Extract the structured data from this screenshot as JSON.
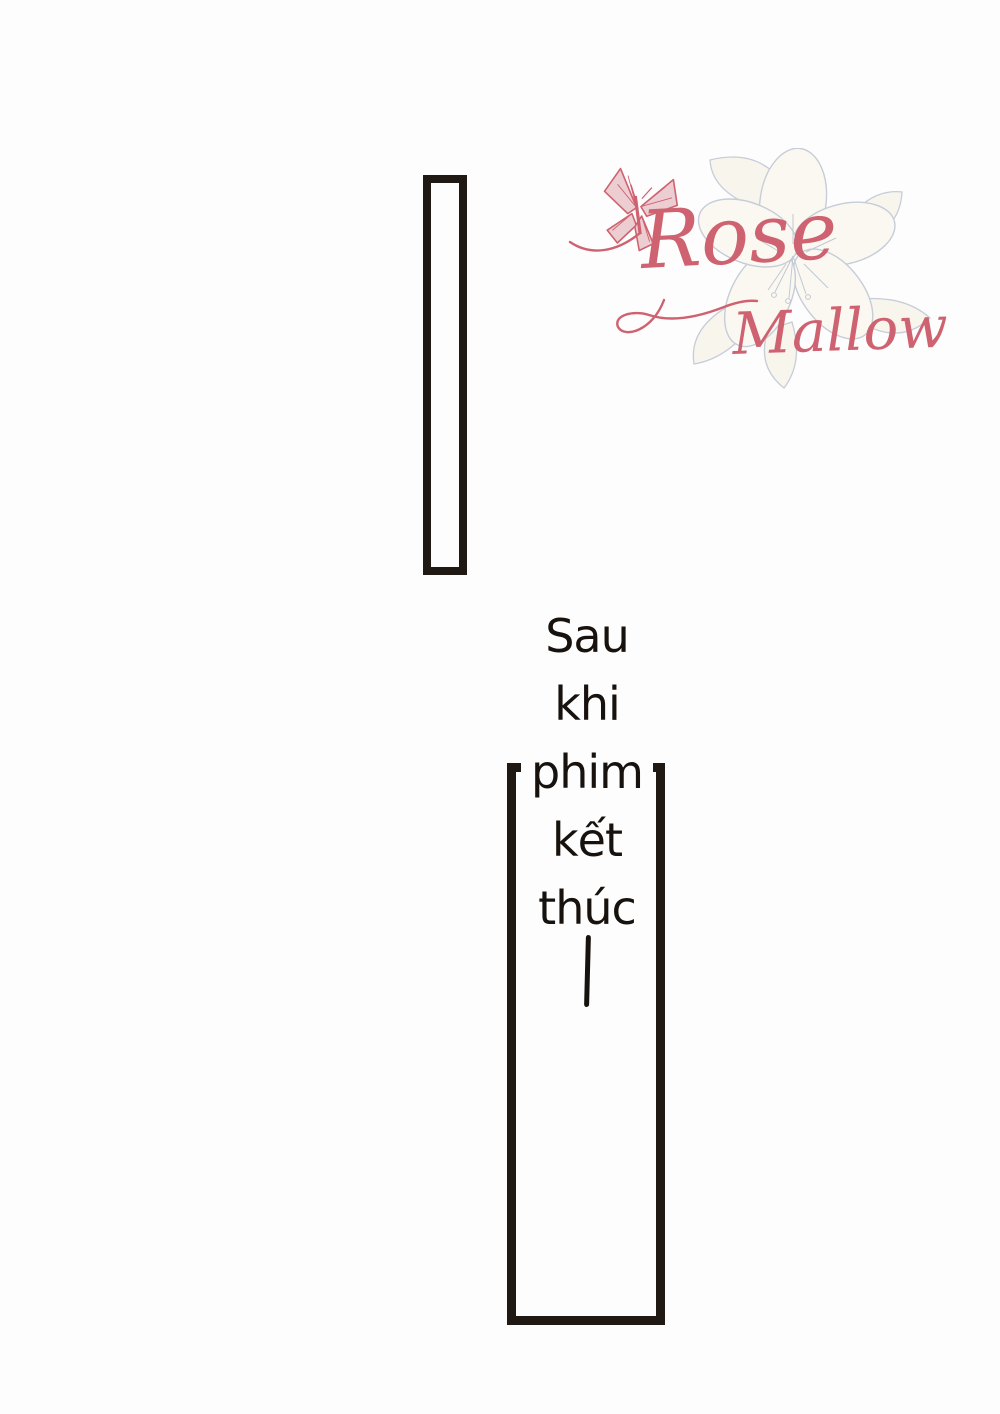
{
  "page": {
    "background_color": "#fdfdfd",
    "kind": "comic transition page"
  },
  "logo": {
    "group_name": "Rose Mallow",
    "word_top": "Rose",
    "word_bottom": "Mallow",
    "accent_color": "#cf6270",
    "sketch_color": "#b9c1cf",
    "icons": [
      "butterfly-icon",
      "hibiscus-sketch-icon"
    ]
  },
  "caption": {
    "full_text": "Sau khi phim kết thúc",
    "words": [
      "Sau",
      "khi",
      "phim",
      "kết",
      "thúc"
    ],
    "ink_color": "#17120e"
  },
  "frames": {
    "border_color": "#201913",
    "count": 2
  }
}
